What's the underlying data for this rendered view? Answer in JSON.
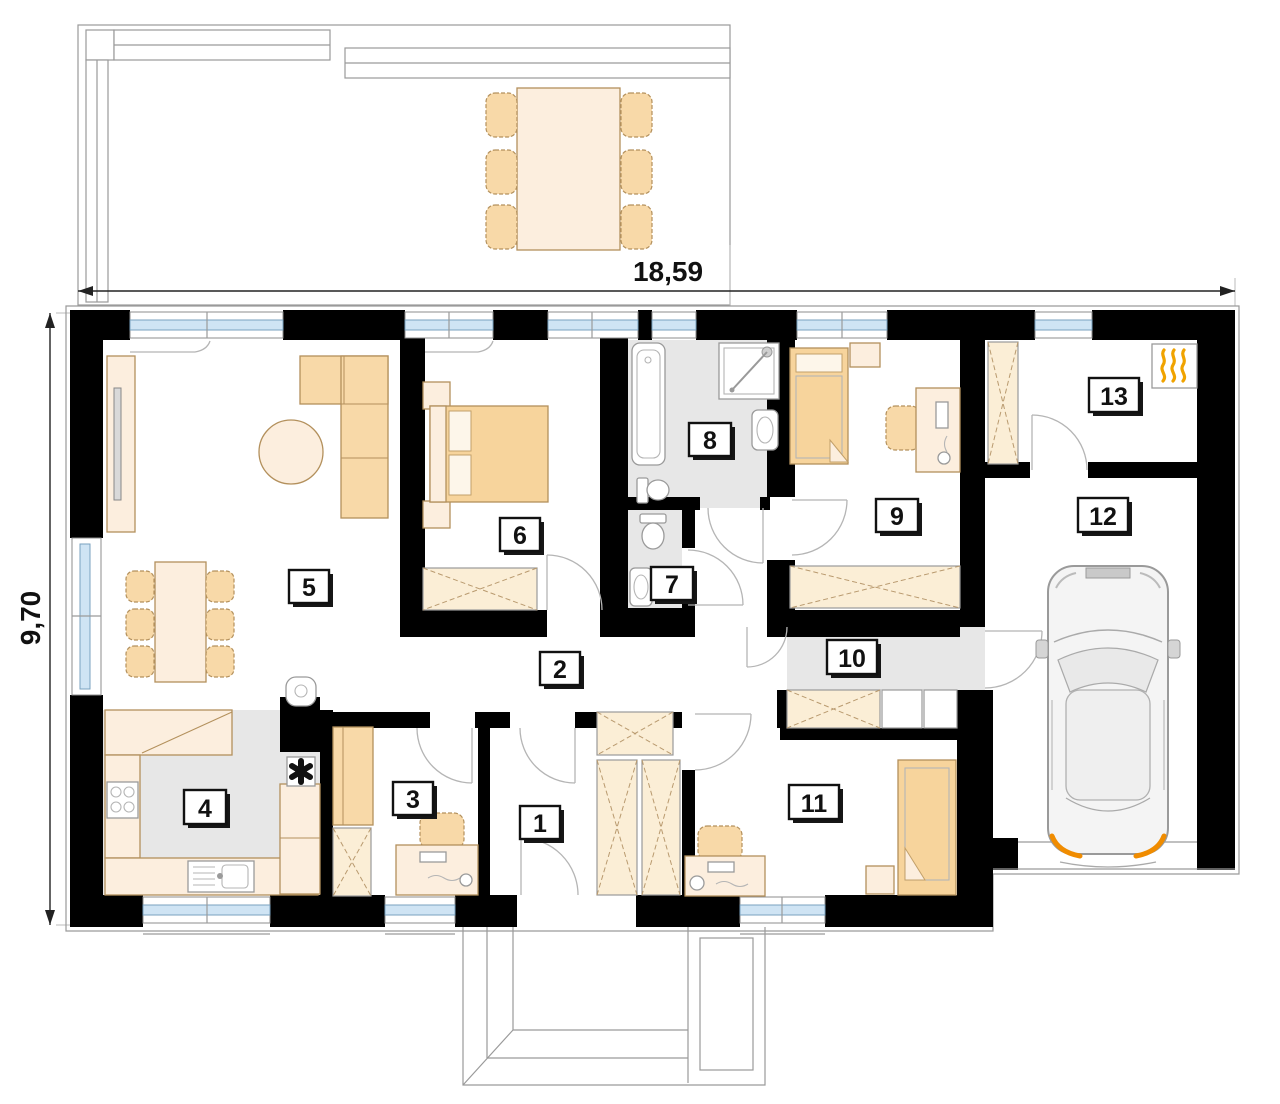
{
  "floor_plan": {
    "dimension_labels": {
      "width": "18,59",
      "height": "9,70"
    },
    "room_numbers": [
      "1",
      "2",
      "3",
      "4",
      "5",
      "6",
      "7",
      "8",
      "9",
      "10",
      "11",
      "12",
      "13"
    ],
    "symbols": {
      "heating": "heating-flames-icon",
      "flue": "flue-fan-icon"
    },
    "colors": {
      "wall": "#000000",
      "furniture_light": "#fceede",
      "furniture_mid": "#f8d9a8",
      "bed": "#f7d49c",
      "floor_gray": "#e7e7e7",
      "window_blue": "#cfe4f4",
      "flame_orange": "#f0a300",
      "taillight_orange": "#f08c00"
    }
  }
}
